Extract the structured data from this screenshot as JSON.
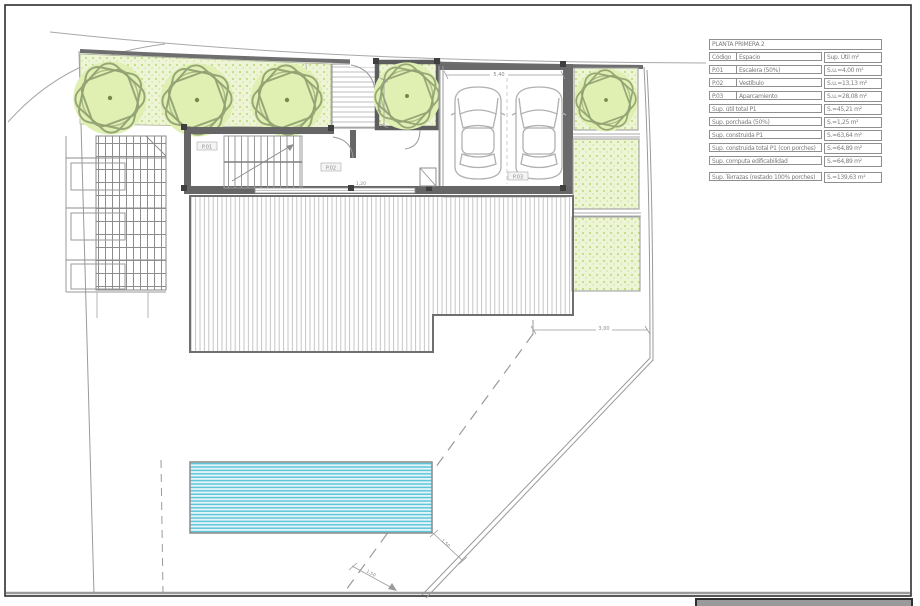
{
  "table": {
    "title": "PLANTA PRIMERA 2",
    "columns": [
      "Código",
      "Espacio",
      "Sup. Útil m²"
    ],
    "rows": [
      {
        "code": "P.01",
        "space": "Escalera (50%)",
        "value": "S.u.=4,00 m²"
      },
      {
        "code": "P.02",
        "space": "Vestíbulo",
        "value": "S.u.=13,13 m²"
      },
      {
        "code": "P.03",
        "space": "Aparcamiento",
        "value": "S.u.=28,08 m²"
      }
    ],
    "summary_rows": [
      {
        "label": "Sup. útil total P1",
        "value": "S.=45,21 m²"
      },
      {
        "label": "Sup. porchada (50%)",
        "value": "S.=1,25 m²"
      },
      {
        "label": "Sup. construida P1",
        "value": "S.=63,64 m²"
      },
      {
        "label": "Sup. construida total P1 (con porches)",
        "value": "S.=64,89 m²"
      },
      {
        "label": "Sup. computa edificabilidad",
        "value": "S.=64,89 m²"
      }
    ],
    "terrace_row": {
      "label": "Sup. Terrazas (restado 100% porches)",
      "value": "S.=139,63 m²"
    }
  },
  "plan": {
    "labels": {
      "p01": "P.01",
      "p02": "P.02",
      "p03": "P.03"
    },
    "dimensions": {
      "garage_width": "5,40",
      "courtyard_depth": "2,40",
      "porch_width": "1,20",
      "boundary_offset": "3,00",
      "pool_offset": "1,50",
      "drive_width": "1,50"
    }
  },
  "colors": {
    "speckle_green": "#c3dc82",
    "tree_fill": "#dff0b2",
    "tree_stroke": "#8f9f70",
    "pool_stripe": "#5ec6da",
    "pool_bg": "#e4f5f9",
    "wall_gray": "#666666"
  }
}
